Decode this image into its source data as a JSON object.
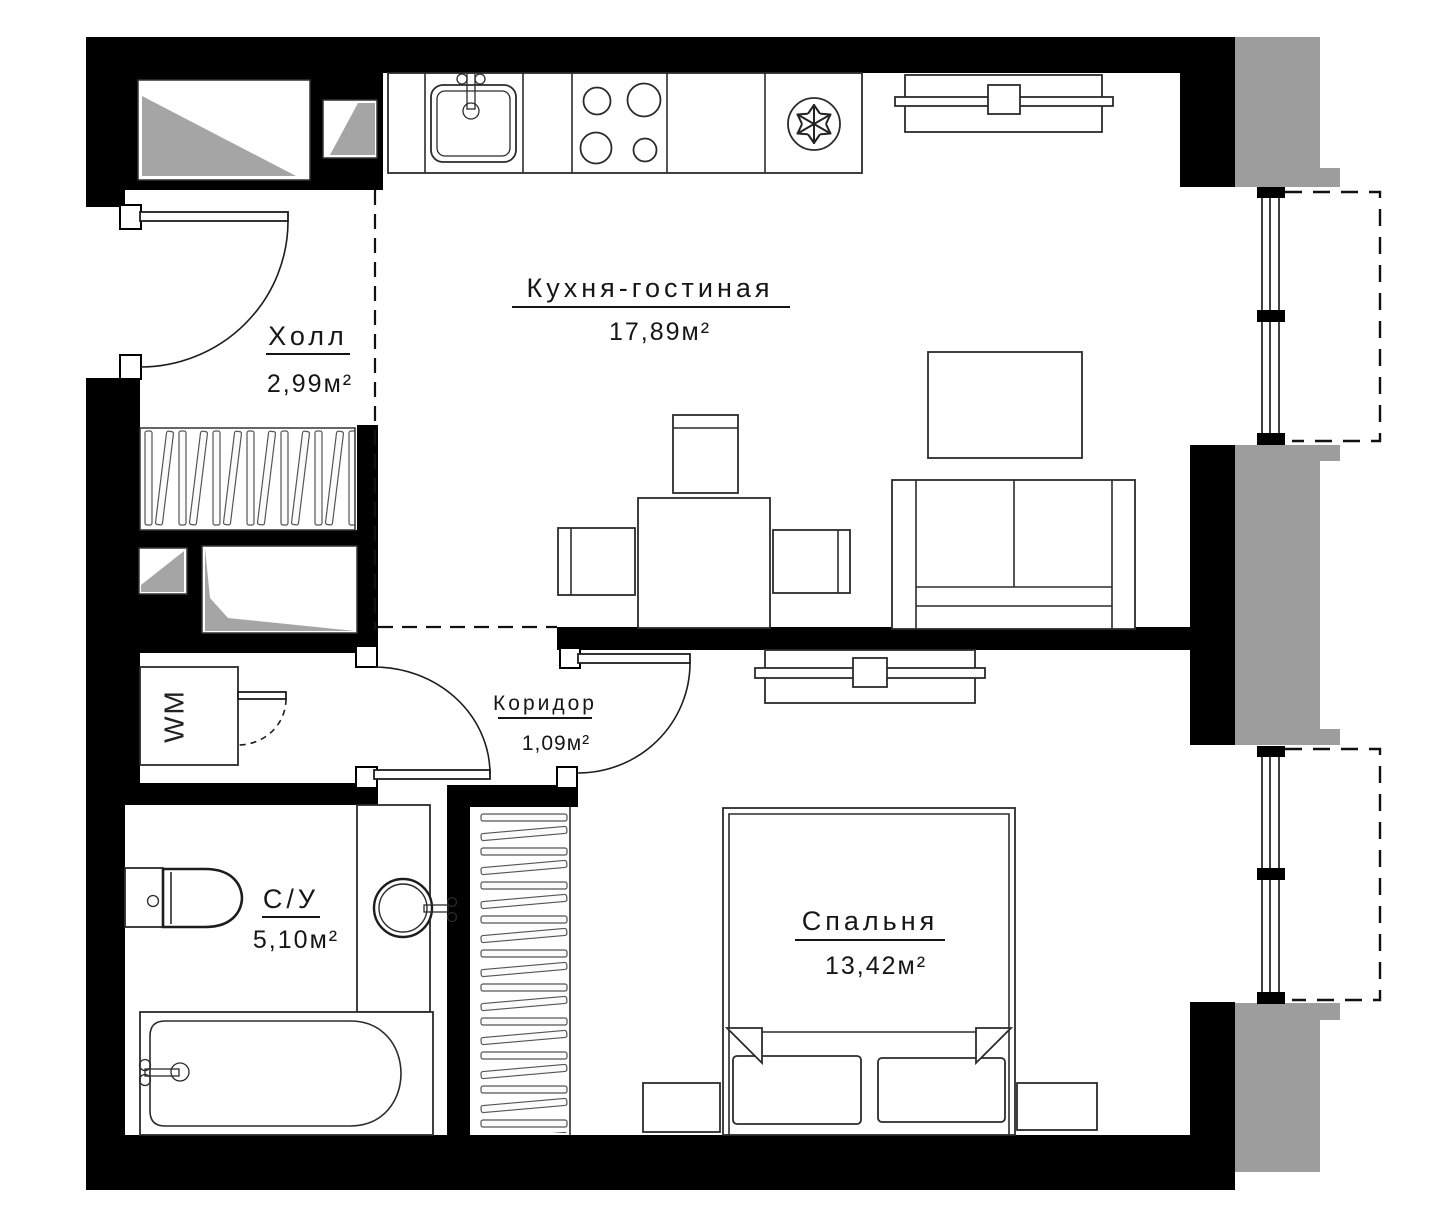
{
  "plan": {
    "type": "apartment-floor-plan",
    "rooms": [
      {
        "key": "kitchen_living",
        "label": "Кухня-гостиная",
        "area": "17,89м²"
      },
      {
        "key": "hall",
        "label": "Холл",
        "area": "2,99м²"
      },
      {
        "key": "corridor",
        "label": "Коридор",
        "area": "1,09м²"
      },
      {
        "key": "bathroom",
        "label": "С/У",
        "area": "5,10м²"
      },
      {
        "key": "bedroom",
        "label": "Спальня",
        "area": "13,42м²"
      }
    ],
    "appliances": {
      "washer_label": "WM"
    },
    "icons": [
      "sink-icon",
      "stove-icon",
      "fridge-snowflake-icon",
      "toilet-icon",
      "bathtub-icon",
      "round-sink-icon",
      "washing-machine-icon",
      "wardrobe-hatch",
      "bed",
      "sofa",
      "dining-table",
      "tv-console",
      "coffee-table",
      "nightstand",
      "window",
      "balcony-dashed-outline",
      "vent-shaft"
    ],
    "colors": {
      "wall": "#000000",
      "exterior_cladding": "#9d9d9d",
      "line": "#1d1d1d",
      "shaft_fill": "#a5a5a5",
      "background": "#ffffff"
    }
  }
}
